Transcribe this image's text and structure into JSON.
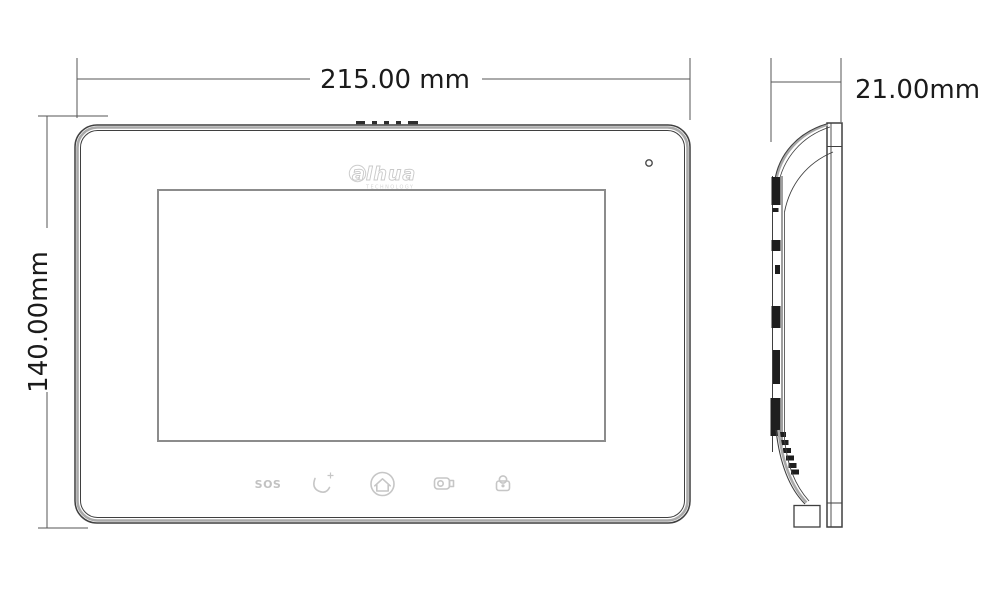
{
  "drawing": {
    "title": "video-intercom-monitor-dimension-drawing",
    "dimensions": {
      "width_label": "215.00 mm",
      "height_label": "140.00mm",
      "depth_label": "21.00mm"
    },
    "front_view": {
      "logo": {
        "text": "alhua",
        "subtext": "TECHNOLOGY"
      },
      "buttons": {
        "sos_label": "SOS",
        "icon_names": [
          "sos-button",
          "call-icon",
          "home-icon",
          "monitor-icon",
          "unlock-icon"
        ]
      },
      "features": [
        "top-vent-slots",
        "mic-hole",
        "screen-panel"
      ]
    },
    "side_view": {
      "features": [
        "front-bezel-bar",
        "curved-back-shell",
        "mounting-rail",
        "vent-slot-strip",
        "wall-foot"
      ]
    },
    "colors": {
      "line": "#3f3f3f",
      "dim_line": "#555555",
      "bezel_band": "#a9a9a9",
      "screen_border": "#8c8c8c",
      "icon": "#c6c6c6",
      "logo": "#c9c9c9",
      "label_text": "#1b1b1b",
      "fill_black": "#1e1e1e"
    }
  }
}
